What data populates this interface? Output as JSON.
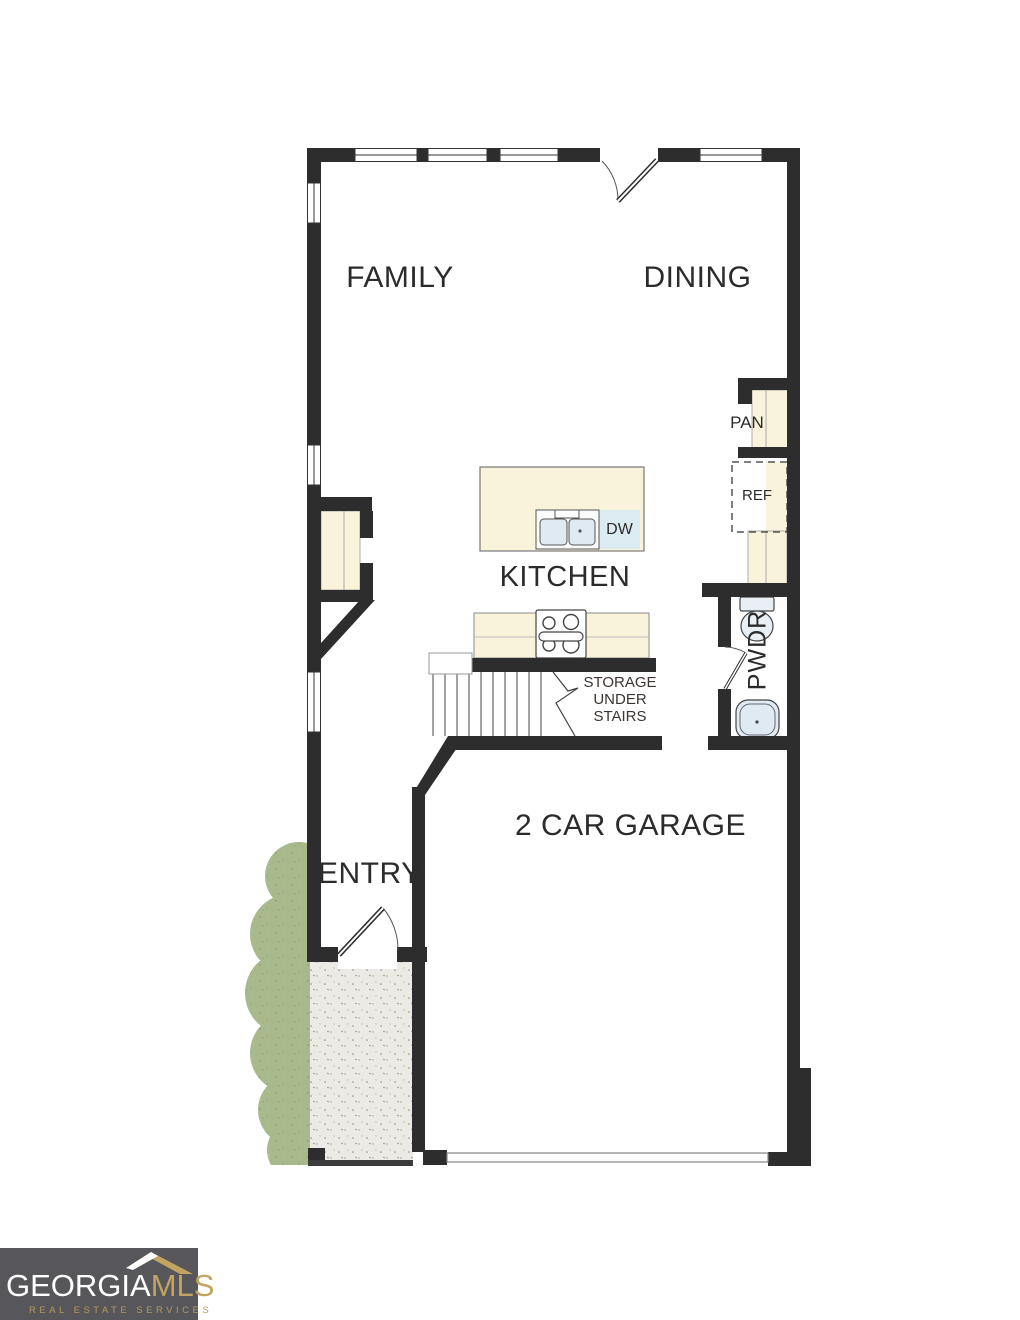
{
  "floorplan": {
    "labels": {
      "family": "FAMILY",
      "dining": "DINING",
      "kitchen": "KITCHEN",
      "pantry": "PAN",
      "refrigerator": "REF",
      "dishwasher": "DW",
      "powder_room": "PWDR",
      "storage": [
        "STORAGE",
        "UNDER",
        "STAIRS"
      ],
      "entry": "ENTRY",
      "garage": "2 CAR GARAGE"
    },
    "colors": {
      "wall": "#2d2d2d",
      "cabinet": "#faf3dc",
      "fixture": "#dfeaf2",
      "shrub": "#a8ba8b",
      "porch": "#eceae5"
    }
  },
  "logo": {
    "brand": "GEORGIA",
    "brand_accent": "MLS",
    "tagline": "REAL ESTATE SERVICES",
    "colors": {
      "background": "#57575b",
      "gold": "#c2a361",
      "text": "#ffffff"
    }
  }
}
